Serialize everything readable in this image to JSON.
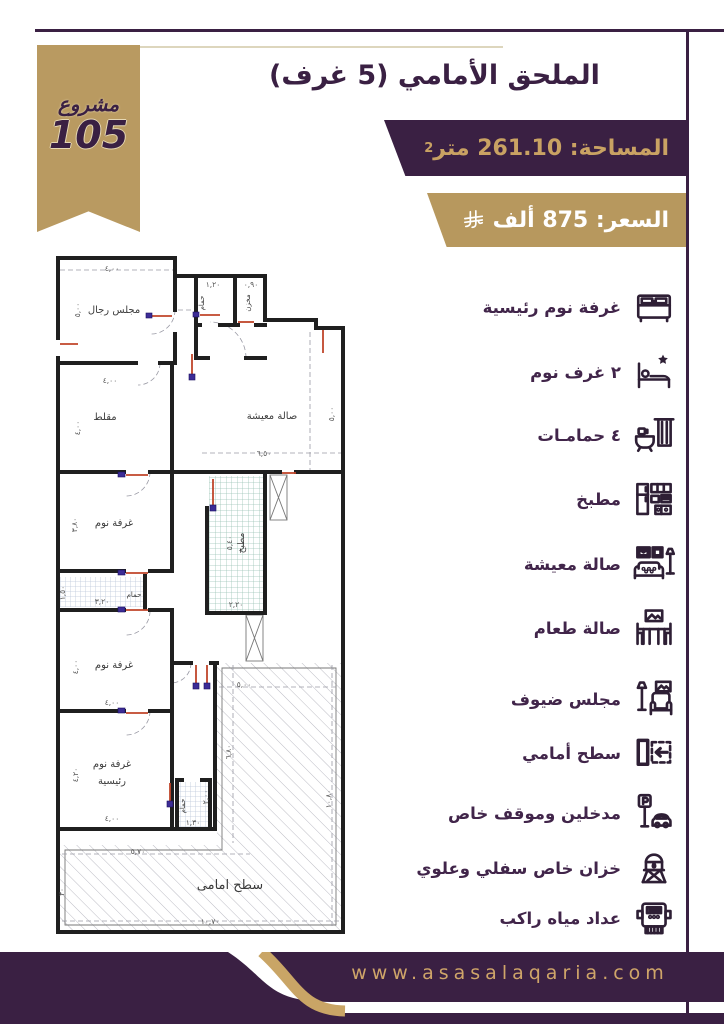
{
  "ribbon": {
    "word": "مشروع",
    "number": "105"
  },
  "header": {
    "title": "الملحق الأمامي (5 غرف)",
    "area_label": "المساحة: 261.10 متر",
    "area_sup": "2",
    "price_label": "السعر: 875 ألف",
    "currency_symbol_name": "riyal-symbol"
  },
  "features": {
    "items": [
      {
        "icon": "master-bed-icon",
        "label": "غرفة نوم رئيسية"
      },
      {
        "icon": "bed-star-icon",
        "label": "٢ غرف نوم"
      },
      {
        "icon": "bathtub-icon",
        "label": "٤ حمامـات"
      },
      {
        "icon": "kitchen-icon",
        "label": "مطبخ"
      },
      {
        "icon": "living-room-icon",
        "label": "صالة معيشة"
      },
      {
        "icon": "dining-room-icon",
        "label": "صالة طعام"
      },
      {
        "icon": "guest-majlis-icon",
        "label": "مجلس ضيوف"
      },
      {
        "icon": "front-roof-icon",
        "label": "سطح أمامي"
      },
      {
        "icon": "parking-icon",
        "label": "مدخلين وموقف خاص"
      },
      {
        "icon": "water-tank-icon",
        "label": "خزان خاص سفلي وعلوي"
      },
      {
        "icon": "water-meter-icon",
        "label": "عداد مياه راكب"
      }
    ]
  },
  "plan": {
    "rooms": [
      {
        "label": "مجلس رجال",
        "x": 64,
        "y": 67,
        "s": 10
      },
      {
        "label": "مقلط",
        "x": 55,
        "y": 174,
        "s": 10
      },
      {
        "label": "صالة معيشة",
        "x": 222,
        "y": 173,
        "s": 10
      },
      {
        "label": "غرفة نوم",
        "x": 64,
        "y": 280,
        "s": 10
      },
      {
        "label": "غرفة نوم",
        "x": 64,
        "y": 422,
        "s": 10
      },
      {
        "label": "غرفة نوم",
        "x": 62,
        "y": 521,
        "s": 10
      },
      {
        "label": "رئيسية",
        "x": 62,
        "y": 538,
        "s": 10
      },
      {
        "label": "حمام",
        "x": 154,
        "y": 57,
        "s": 7,
        "r": -90
      },
      {
        "label": "مخزن",
        "x": 200,
        "y": 57,
        "s": 7,
        "r": -90
      },
      {
        "label": "حمام",
        "x": 84,
        "y": 351,
        "s": 7
      },
      {
        "label": "حمام",
        "x": 135,
        "y": 560,
        "s": 7,
        "r": -90
      },
      {
        "label": "مطبخ",
        "x": 194,
        "y": 297,
        "s": 9,
        "r": -90
      },
      {
        "label": "سطح امامى",
        "x": 180,
        "y": 643,
        "s": 13
      }
    ],
    "dims": [
      {
        "t": "٤,٠٠",
        "x": 62,
        "y": 25
      },
      {
        "t": "١,٢٠",
        "x": 163,
        "y": 41
      },
      {
        "t": "٠,٩٠",
        "x": 201,
        "y": 41
      },
      {
        "t": "٥,٠٠",
        "x": 30,
        "y": 64,
        "r": -90
      },
      {
        "t": "٤,٠٠",
        "x": 60,
        "y": 137
      },
      {
        "t": "٤,٠٠",
        "x": 30,
        "y": 182,
        "r": -90
      },
      {
        "t": "٦,٥٠",
        "x": 214,
        "y": 210
      },
      {
        "t": "٥,٠٠",
        "x": 284,
        "y": 168,
        "r": -90
      },
      {
        "t": "٣,٨٠",
        "x": 27,
        "y": 279,
        "r": -90
      },
      {
        "t": "٣,٢٠",
        "x": 52,
        "y": 358
      },
      {
        "t": "١,٥٠",
        "x": 15,
        "y": 347,
        "r": -90
      },
      {
        "t": "٥,٤٠",
        "x": 182,
        "y": 297,
        "r": -90
      },
      {
        "t": "٢,٢٠",
        "x": 186,
        "y": 361
      },
      {
        "t": "٤,٠٠",
        "x": 62,
        "y": 459
      },
      {
        "t": "٤,٠٠",
        "x": 28,
        "y": 421,
        "r": -90
      },
      {
        "t": "٤,٢٠",
        "x": 28,
        "y": 529,
        "r": -90
      },
      {
        "t": "٤,٠٠",
        "x": 62,
        "y": 575
      },
      {
        "t": "١,٣٠",
        "x": 143,
        "y": 579
      },
      {
        "t": "٢,٠٠",
        "x": 158,
        "y": 551,
        "r": -90
      },
      {
        "t": "٥,٠٠",
        "x": 194,
        "y": 441
      },
      {
        "t": "٦,٨٠",
        "x": 181,
        "y": 506,
        "r": -90
      },
      {
        "t": "١٠,٨٠",
        "x": 281,
        "y": 553,
        "r": -90
      },
      {
        "t": "٥,٧٠",
        "x": 88,
        "y": 608
      },
      {
        "t": "١٠,٧٠",
        "x": 160,
        "y": 678
      },
      {
        "t": "٣٠",
        "x": 14,
        "y": 646,
        "r": -90
      }
    ]
  },
  "footer": {
    "website": "www.asasalaqaria.com"
  },
  "colors": {
    "purple": "#3a2043",
    "gold": "#b7985e",
    "gold_text": "#c9a263",
    "beige_line": "#ddd6bd"
  }
}
